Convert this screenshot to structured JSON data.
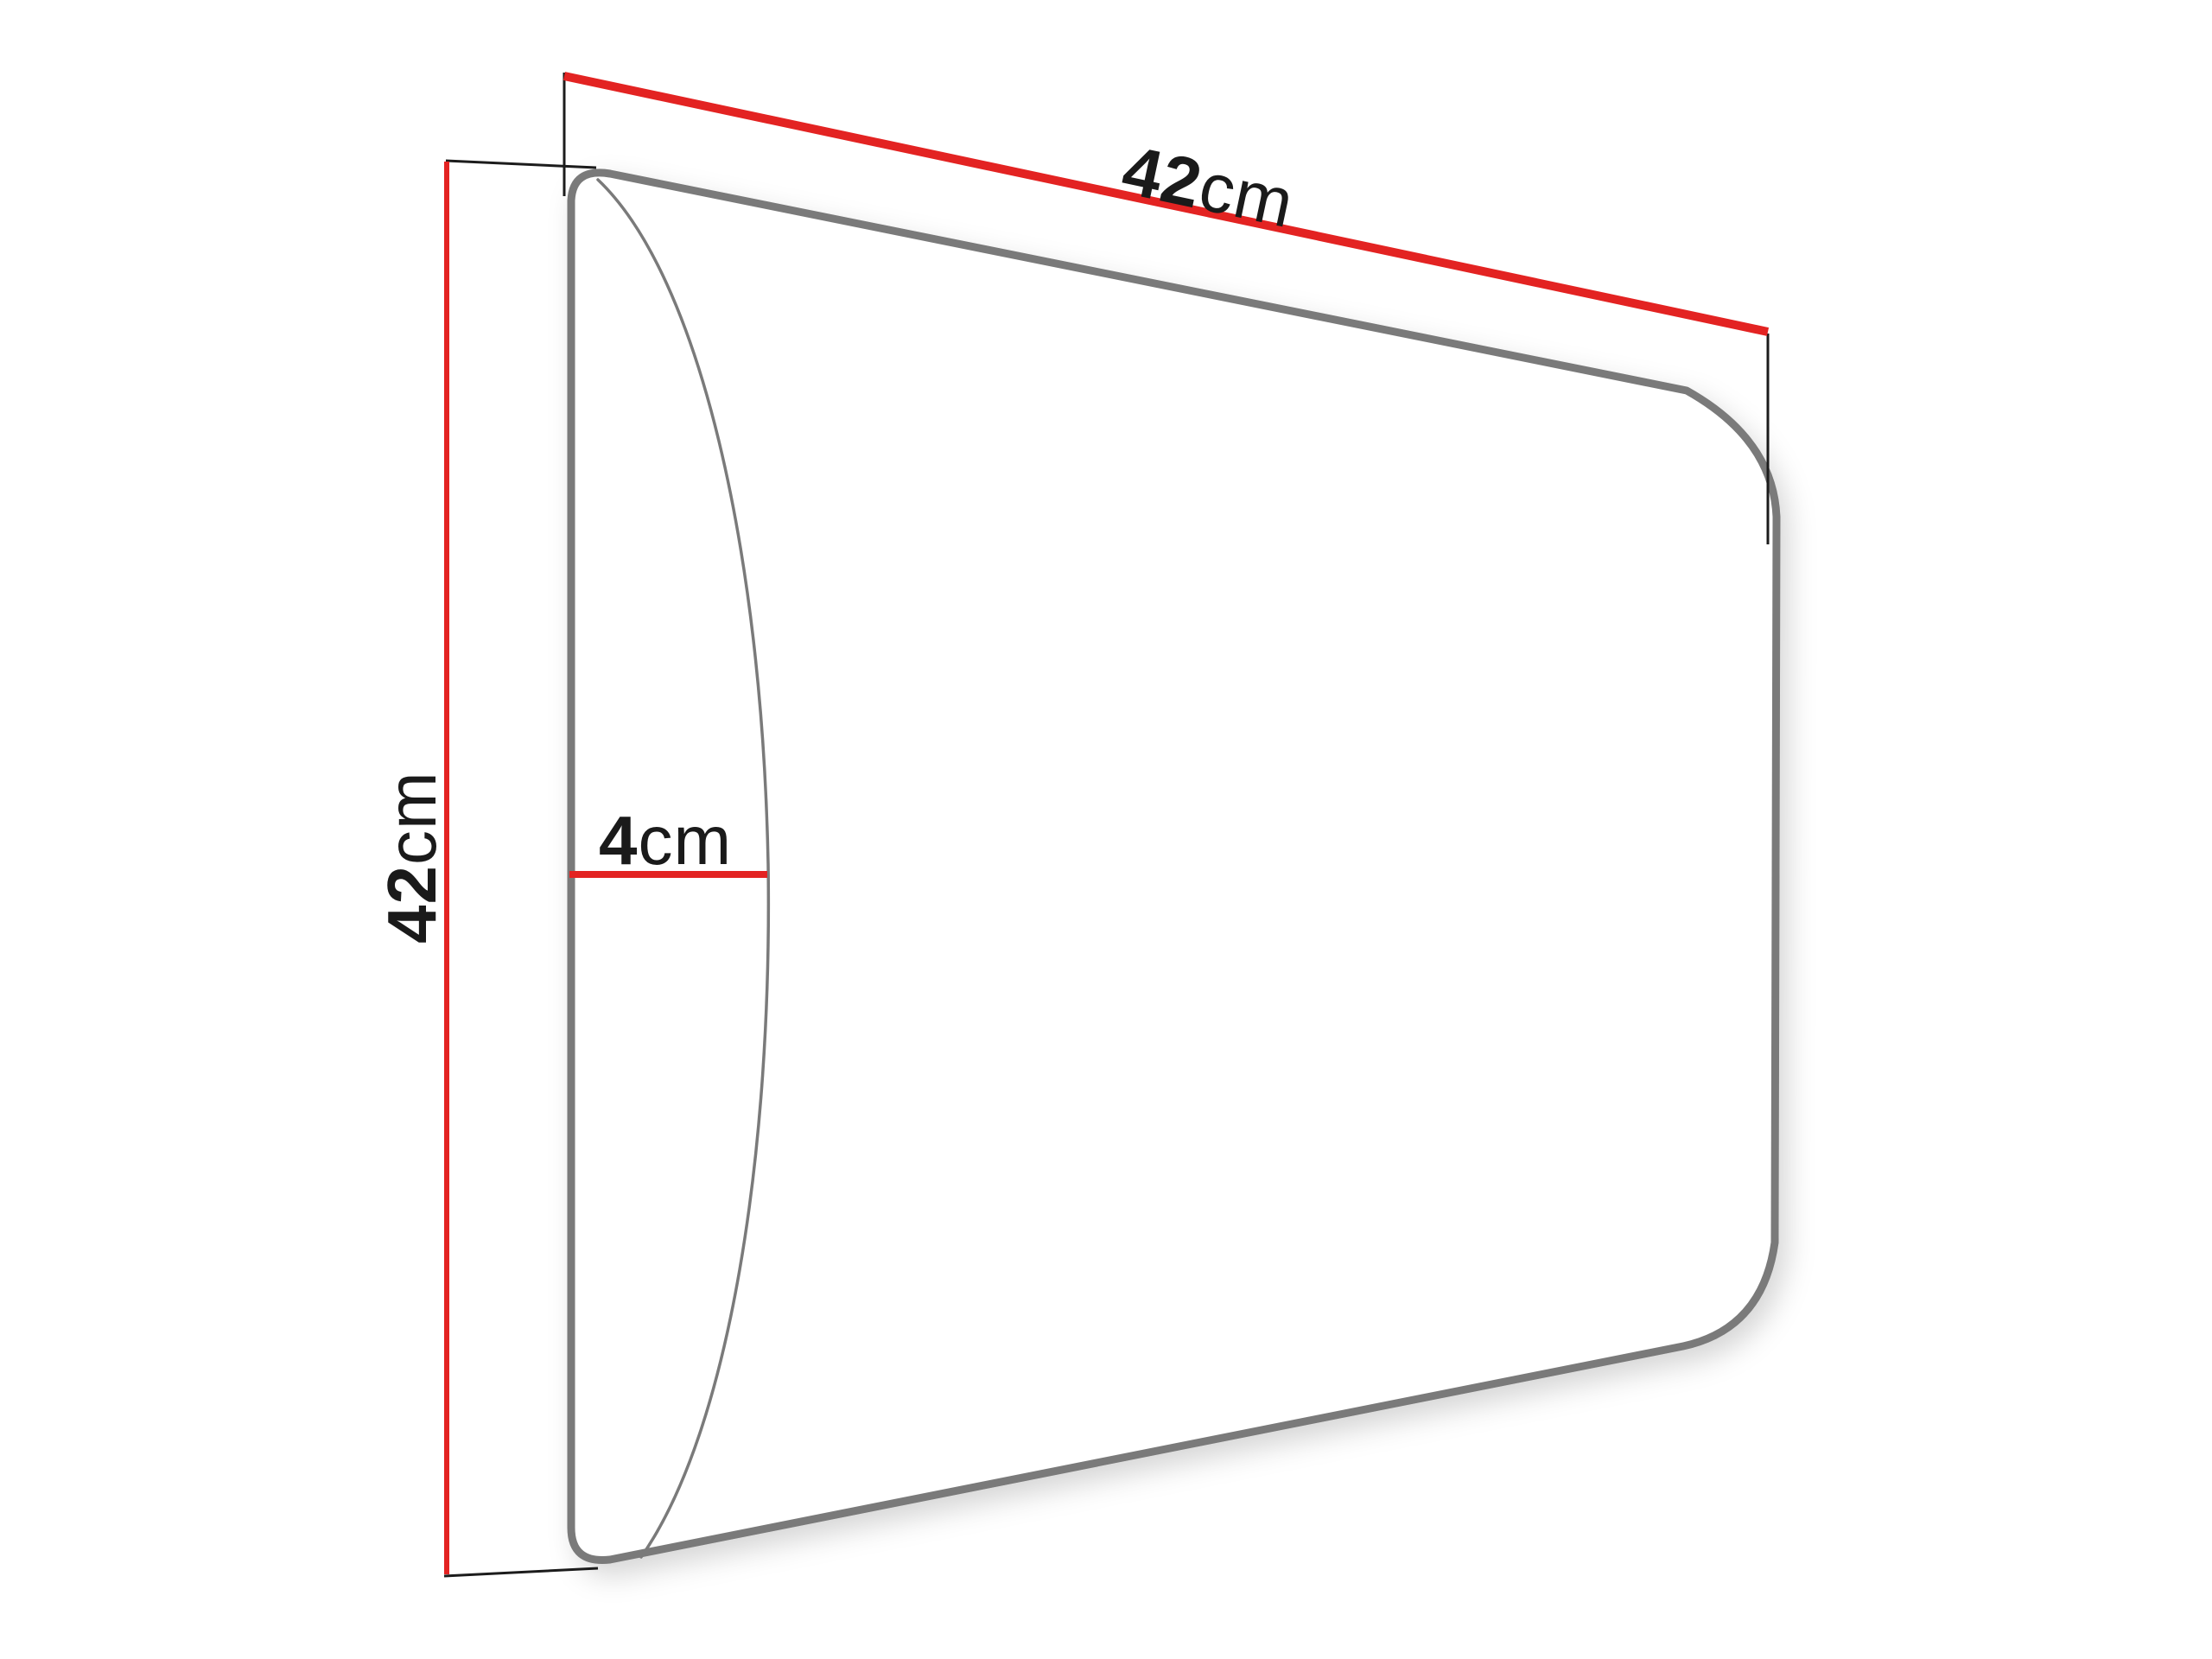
{
  "diagram": {
    "dimensions": {
      "width": {
        "value": "42",
        "unit": "cm"
      },
      "height": {
        "value": "42",
        "unit": "cm"
      },
      "depth": {
        "value": "4",
        "unit": "cm"
      }
    },
    "colors": {
      "dimension_line": "#e32322",
      "panel_outline": "#7a7a7a",
      "extension_line": "#1c1c1c",
      "label_text": "#1a1a1a",
      "background": "#ffffff"
    }
  }
}
